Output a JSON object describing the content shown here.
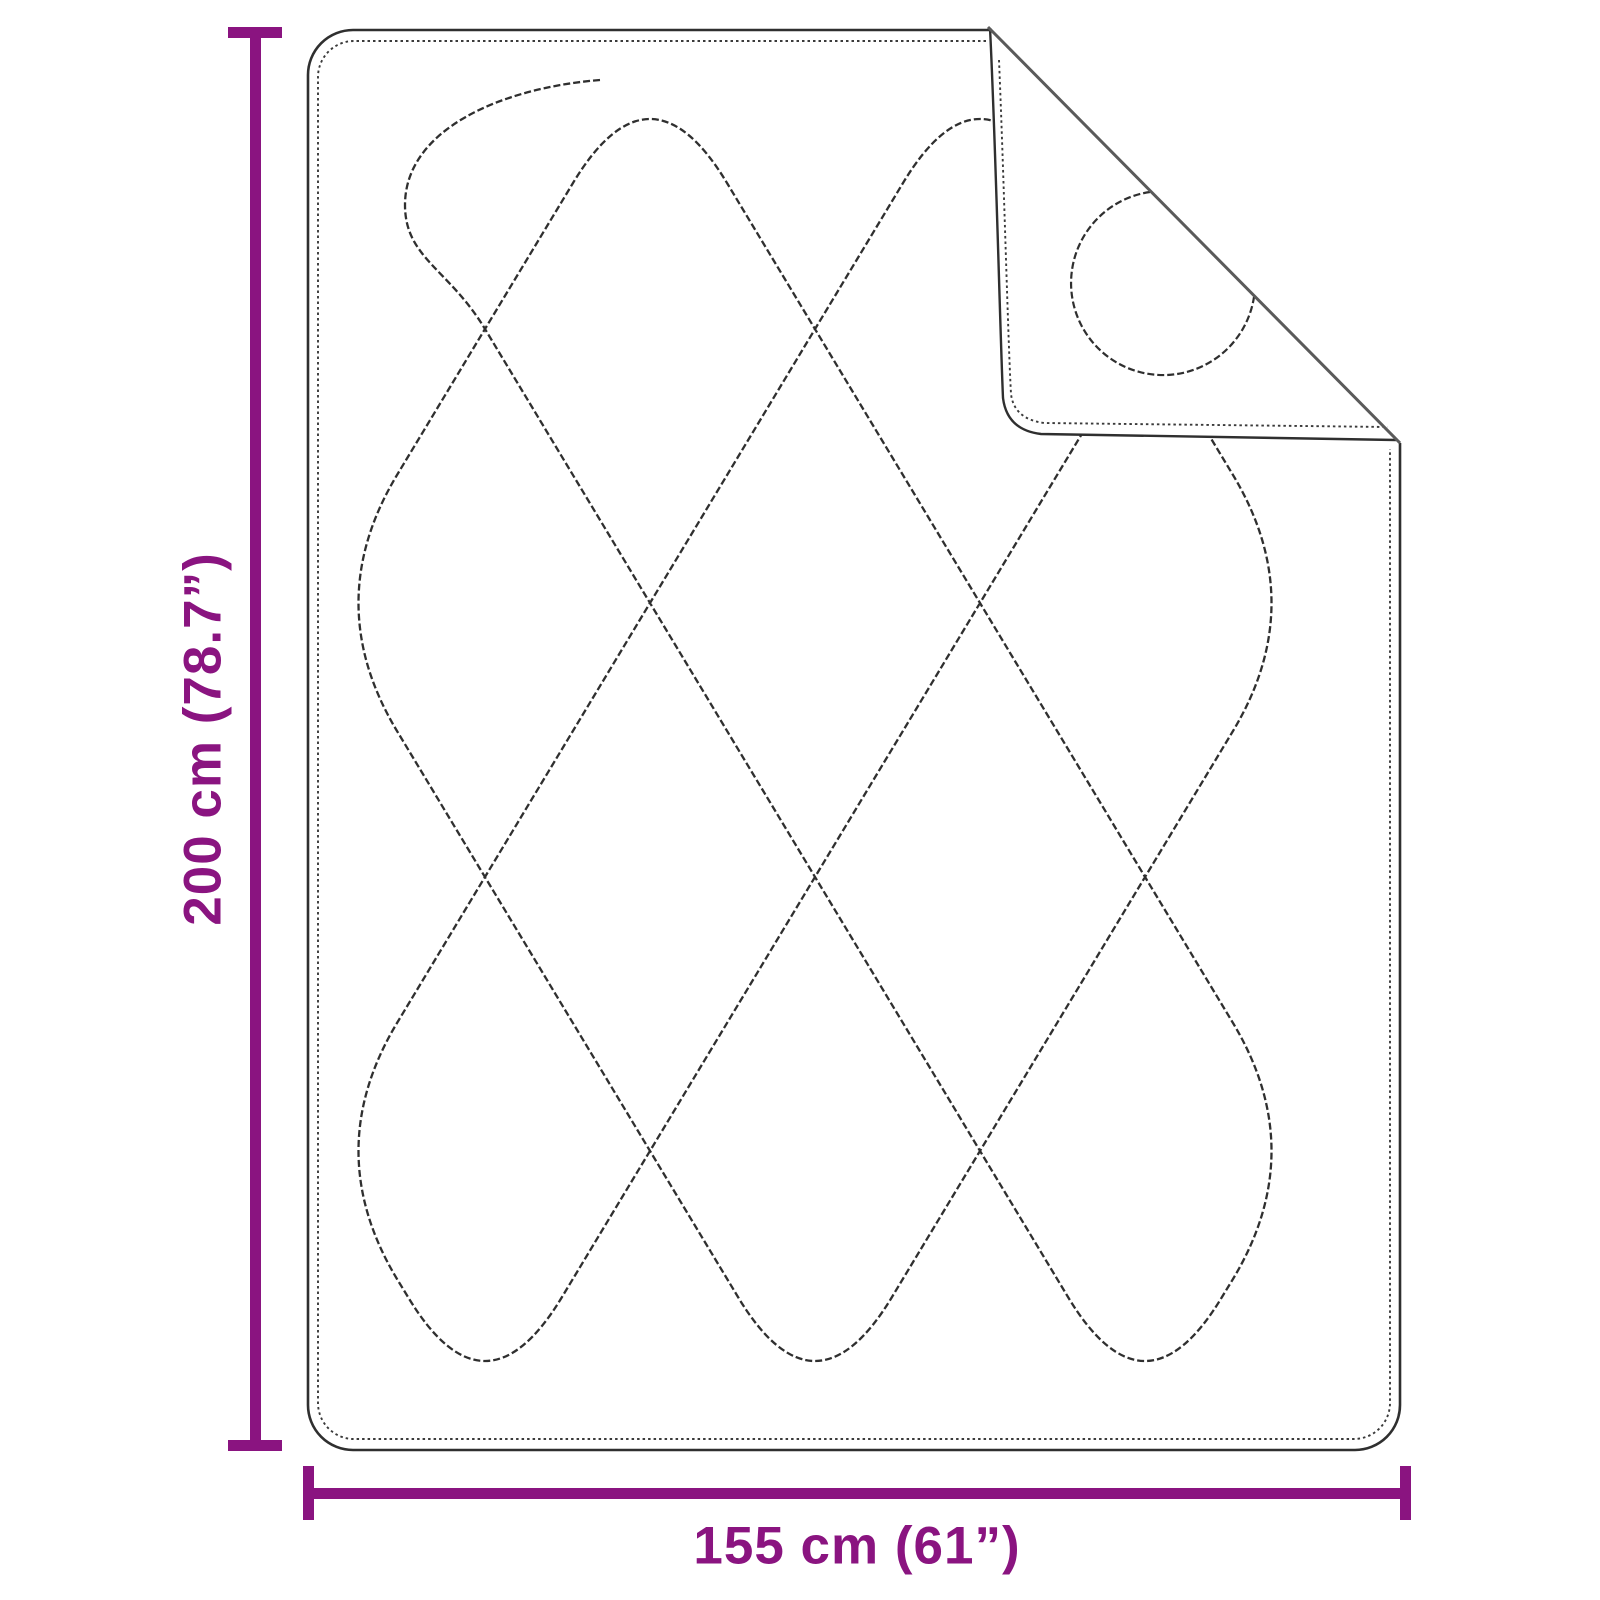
{
  "diagram": {
    "title": "blanket-dimension-diagram",
    "height_dimension": {
      "label": "200 cm (78.7”)"
    },
    "width_dimension": {
      "label": "155 cm (61”)"
    }
  },
  "colors": {
    "dimension_accent": "#8A1480",
    "outline_line": "#2F2F2F",
    "stitch_line": "#3A3A3A",
    "fold_crease": "#5A5A5A",
    "background": "#FFFFFF"
  }
}
